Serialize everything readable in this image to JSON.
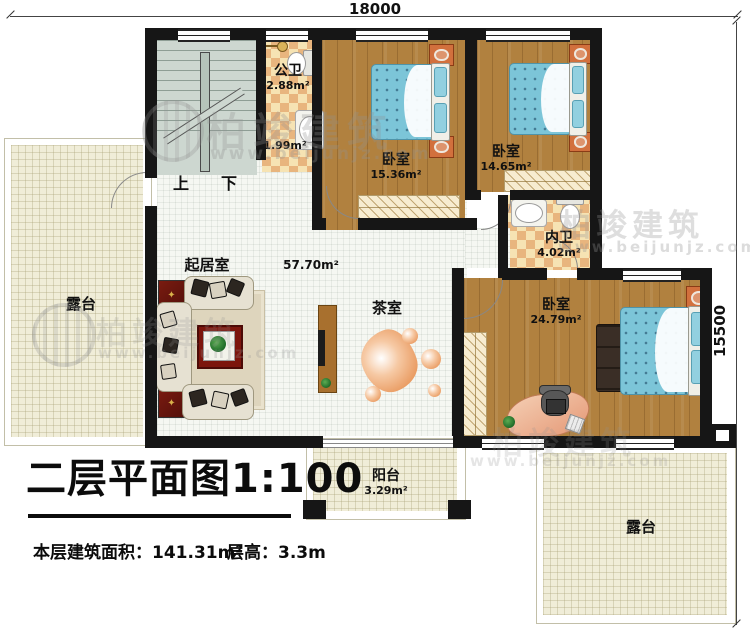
{
  "dimensions": {
    "top_width": "18000",
    "right_height": "15500"
  },
  "stairs": {
    "up_label": "上",
    "down_label": "下"
  },
  "rooms": {
    "public_bath": {
      "name": "公卫",
      "area": "2.88m²"
    },
    "wash_nook": {
      "area": "1.99m²"
    },
    "bedroom_top_left": {
      "name": "卧室",
      "area": "15.36m²"
    },
    "bedroom_top_right": {
      "name": "卧室",
      "area": "14.65m²"
    },
    "inner_bath": {
      "name": "内卫",
      "area": "4.02m²"
    },
    "bedroom_master": {
      "name": "卧室",
      "area": "24.79m²"
    },
    "living_room": {
      "name": "起居室",
      "area": "57.70m²"
    },
    "tea_room": {
      "name": "茶室"
    },
    "terrace_left": {
      "name": "露台"
    },
    "terrace_right": {
      "name": "露台"
    },
    "balcony": {
      "name": "阳台",
      "area": "3.29m²"
    }
  },
  "title_block": {
    "title": "二层平面图1:100",
    "floor_area_label": "本层建筑面积：",
    "floor_area_value": "141.31m²",
    "floor_height_label": "层高：",
    "floor_height_value": "3.3m"
  },
  "watermark": {
    "brand": "柏竣建筑",
    "site": "www.beijunjz.com"
  },
  "icons": {
    "cabinet_ornament": "✦"
  },
  "colors": {
    "wall": "#161616",
    "wood_floor": "#b1813f",
    "stair_floor": "#cdd7d0",
    "checker_light": "#f6e3b3",
    "checker_dark": "#e8b57e",
    "terrace_floor": "#f0edd8",
    "living_floor": "#f5f7f2",
    "bed": "#7cc5d8",
    "cabinet_red": "#7a1b10",
    "stone_peach": "#e99a60"
  }
}
